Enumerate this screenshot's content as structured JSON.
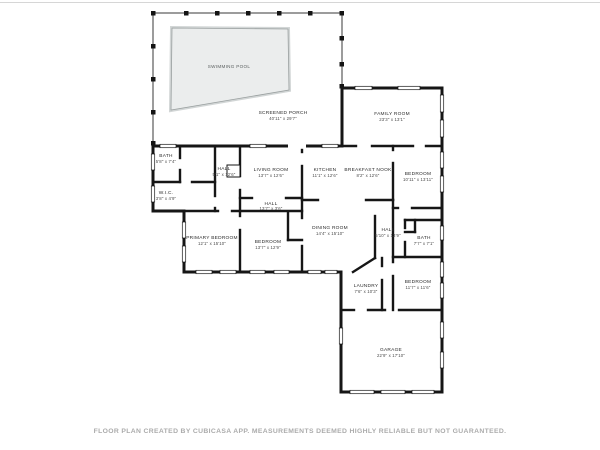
{
  "footer": "FLOOR PLAN CREATED BY CUBICASA APP. MEASUREMENTS DEEMED HIGHLY RELIABLE BUT NOT GUARANTEED.",
  "colors": {
    "wall": "#161616",
    "pool_fill": "#ebeded",
    "pool_border": "#9aa0a0",
    "footer_text": "#ababab"
  },
  "rooms": {
    "swimming_pool": {
      "name": "SWIMMING POOL",
      "dims": ""
    },
    "screened_porch": {
      "name": "SCREENED PORCH",
      "dims": "40'11\" x 29'7\""
    },
    "bath_nw": {
      "name": "BATH",
      "dims": "5'8\" x 7'4\""
    },
    "wic": {
      "name": "W.I.C.",
      "dims": "3'8\" x 4'9\""
    },
    "hall_nw": {
      "name": "HALL",
      "dims": "5'1\" x 12'6\""
    },
    "living_room": {
      "name": "LIVING ROOM",
      "dims": "13'7\" x 12'6\""
    },
    "kitchen": {
      "name": "KITCHEN",
      "dims": "11'1\" x 12'6\""
    },
    "breakfast_nook": {
      "name": "BREAKFAST NOOK",
      "dims": "8'2\" x 12'6\""
    },
    "family_room": {
      "name": "FAMILY ROOM",
      "dims": "23'3\" x 13'1\""
    },
    "bedroom_east": {
      "name": "BEDROOM",
      "dims": "10'11\" x 13'11\""
    },
    "hall_north": {
      "name": "HALL",
      "dims": "13'7\" x 3'6\""
    },
    "primary_bedroom": {
      "name": "PRIMARY BEDROOM",
      "dims": "12'1\" x 15'10\""
    },
    "bedroom_mid": {
      "name": "BEDROOM",
      "dims": "13'7\" x 12'9\""
    },
    "dining_room": {
      "name": "DINING ROOM",
      "dims": "14'4\" x 15'10\""
    },
    "hall_south": {
      "name": "HALL",
      "dims": "5'10\" x 13'9\""
    },
    "bath_south": {
      "name": "BATH",
      "dims": "7'7\" x 7'1\""
    },
    "laundry": {
      "name": "LAUNDRY",
      "dims": "7'6\" x 10'3\""
    },
    "bedroom_south": {
      "name": "BEDROOM",
      "dims": "11'7\" x 11'6\""
    },
    "garage": {
      "name": "GARAGE",
      "dims": "22'9\" x 17'10\""
    }
  }
}
